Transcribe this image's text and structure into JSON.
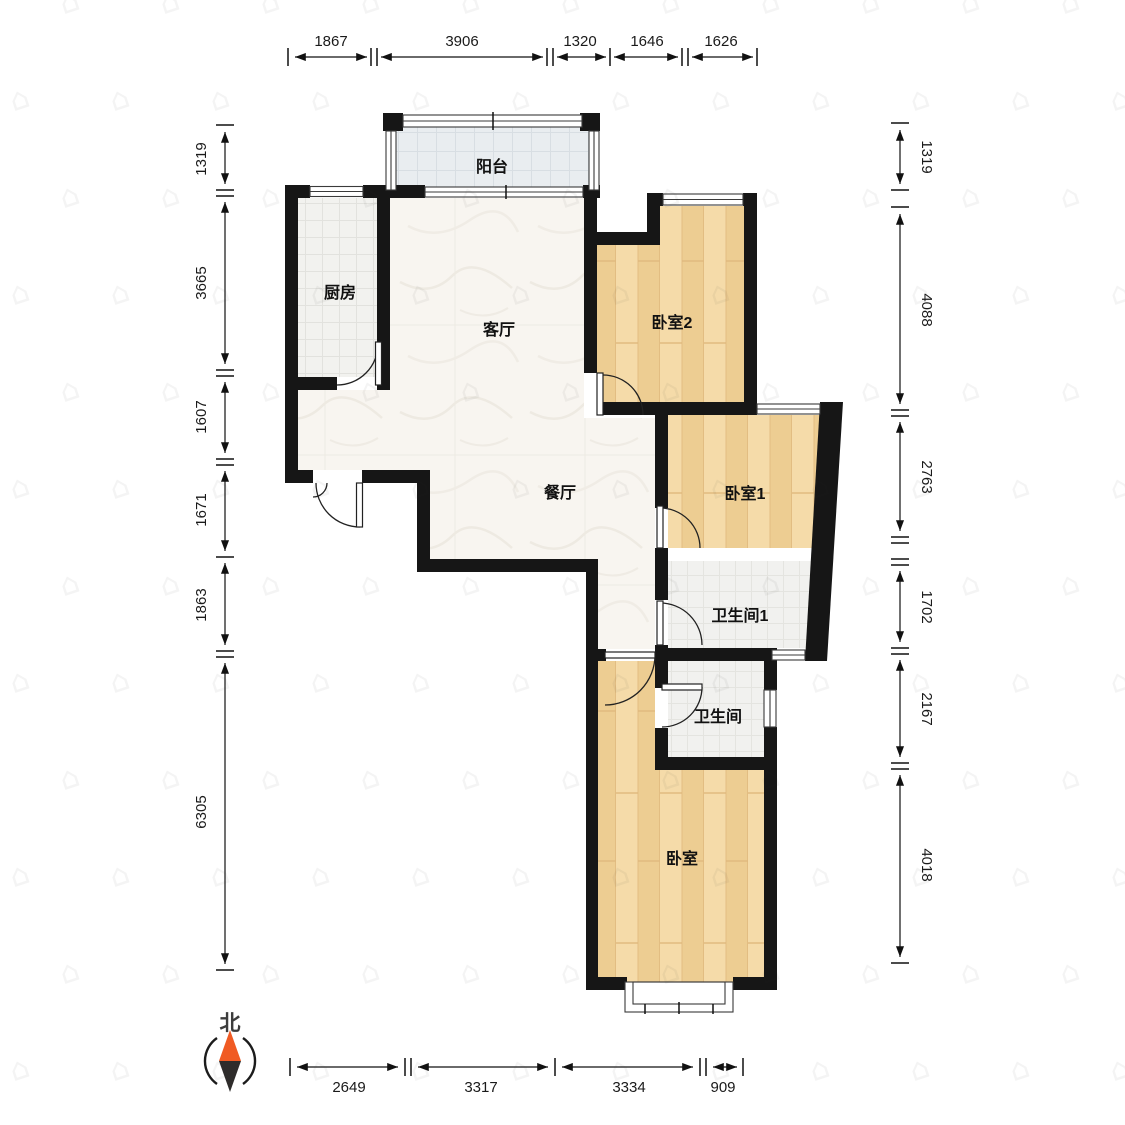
{
  "page": {
    "type": "apartment-floor-plan"
  },
  "rooms": {
    "balcony": "阳台",
    "kitchen": "厨房",
    "living": "客厅",
    "dining": "餐厅",
    "bedroom2": "卧室2",
    "bedroom1": "卧室1",
    "bathroom1": "卫生间1",
    "bathroom": "卫生间",
    "bedroom": "卧室"
  },
  "compass": {
    "label": "北",
    "needle_top_color": "#f05a23",
    "needle_bottom_color": "#2e2c2b"
  },
  "dims": {
    "top": [
      {
        "v": "1867"
      },
      {
        "v": "3906"
      },
      {
        "v": "1320"
      },
      {
        "v": "1646"
      },
      {
        "v": "1626"
      }
    ],
    "bottom": [
      {
        "v": "2649"
      },
      {
        "v": "3317"
      },
      {
        "v": "3334"
      },
      {
        "v": "909"
      }
    ],
    "left": [
      {
        "v": "1319"
      },
      {
        "v": "3665"
      },
      {
        "v": "1607"
      },
      {
        "v": "1671"
      },
      {
        "v": "1863"
      },
      {
        "v": "6305"
      }
    ],
    "right": [
      {
        "v": "1319"
      },
      {
        "v": "4088"
      },
      {
        "v": "2763"
      },
      {
        "v": "1702"
      },
      {
        "v": "2167"
      },
      {
        "v": "4018"
      }
    ]
  },
  "colors": {
    "wall": "#161616",
    "wood_floor": "#f2d49c",
    "marble_floor": "#f8f5f0",
    "balcony_floor": "#e9edf0",
    "kitchen_floor": "#f2f2ef",
    "bath_floor": "#f1f1ef"
  },
  "watermark": {
    "glyph": "⌂"
  }
}
